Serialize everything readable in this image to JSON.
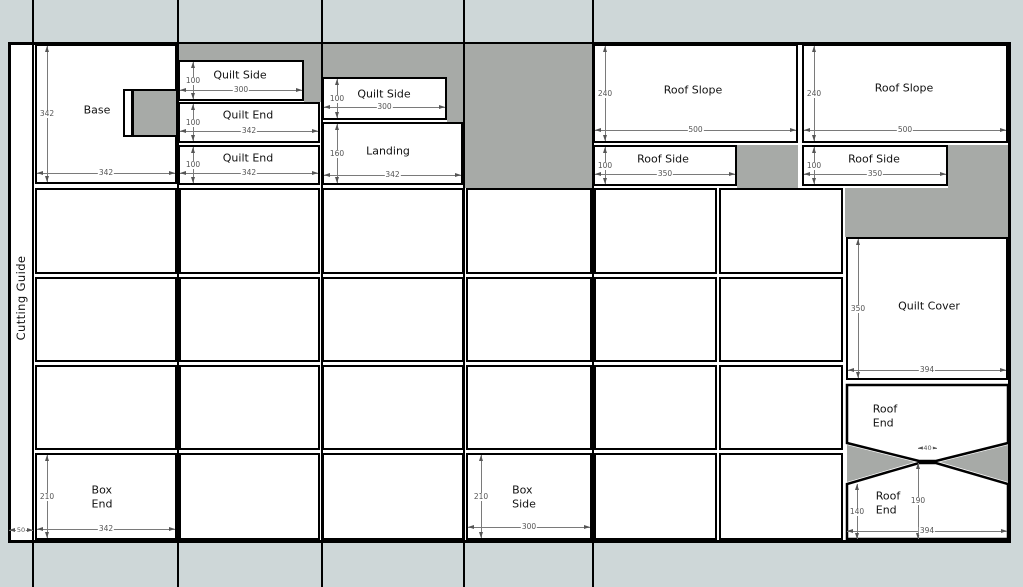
{
  "title": "Cutting Guide",
  "colors": {
    "background": "#ced7d8",
    "sheet": "#ffffff",
    "waste": "#a7aaa7",
    "outline": "#000000",
    "dim_line": "#7a7a7a",
    "dim_text": "#555555"
  },
  "sheet": {
    "x": 8,
    "y": 42,
    "w": 1003,
    "h": 501
  },
  "cut_lines_x": [
    33,
    178,
    322,
    464,
    593
  ],
  "waste_rects": [
    [
      178,
      44,
      144,
      16
    ],
    [
      304,
      60,
      18,
      42
    ],
    [
      322,
      44,
      142,
      33
    ],
    [
      447,
      77,
      17,
      45
    ],
    [
      464,
      44,
      129,
      144
    ],
    [
      737,
      145,
      61,
      43
    ],
    [
      948,
      145,
      60,
      43
    ],
    [
      845,
      188,
      163,
      49
    ]
  ],
  "notch_grey": [
    132,
    89,
    46,
    48
  ],
  "notch_white": [
    123,
    89,
    10,
    48
  ],
  "pieces": [
    {
      "name": "base",
      "label": "Base",
      "x": 35,
      "y": 44,
      "w": 142,
      "h": 140,
      "lc": [
        62,
        66
      ],
      "vdim": {
        "v": "342",
        "x": 10
      },
      "hdim": {
        "v": "342",
        "y": 127
      }
    },
    {
      "name": "quilt-side-1",
      "label": "Quilt Side",
      "x": 178,
      "y": 60,
      "w": 126,
      "h": 41,
      "lc": [
        62,
        15
      ],
      "vdim": {
        "v": "100",
        "x": 13
      },
      "hdim": {
        "v": "300",
        "y": 28
      }
    },
    {
      "name": "quilt-end-1",
      "label": "Quilt End",
      "x": 178,
      "y": 102,
      "w": 142,
      "h": 41,
      "lc": [
        70,
        13
      ],
      "vdim": {
        "v": "100",
        "x": 13
      },
      "hdim": {
        "v": "342",
        "y": 27
      }
    },
    {
      "name": "quilt-end-2",
      "label": "Quilt End",
      "x": 178,
      "y": 145,
      "w": 142,
      "h": 40,
      "lc": [
        70,
        13
      ],
      "vdim": {
        "v": "100",
        "x": 13
      },
      "hdim": {
        "v": "342",
        "y": 26
      }
    },
    {
      "name": "quilt-side-2",
      "label": "Quilt Side",
      "x": 322,
      "y": 77,
      "w": 125,
      "h": 43,
      "lc": [
        62,
        17
      ],
      "vdim": {
        "v": "100",
        "x": 13
      },
      "hdim": {
        "v": "300",
        "y": 28
      }
    },
    {
      "name": "landing",
      "label": "Landing",
      "x": 322,
      "y": 122,
      "w": 141,
      "h": 63,
      "lc": [
        66,
        29
      ],
      "vdim": {
        "v": "160",
        "x": 13
      },
      "hdim": {
        "v": "342",
        "y": 51
      }
    },
    {
      "name": "roof-slope-1",
      "label": "Roof Slope",
      "x": 593,
      "y": 44,
      "w": 205,
      "h": 99,
      "lc": [
        100,
        46
      ],
      "vdim": {
        "v": "240",
        "x": 10
      },
      "hdim": {
        "v": "500",
        "y": 84
      }
    },
    {
      "name": "roof-side-1",
      "label": "Roof Side",
      "x": 593,
      "y": 145,
      "w": 144,
      "h": 41,
      "lc": [
        70,
        14
      ],
      "vdim": {
        "v": "100",
        "x": 10
      },
      "hdim": {
        "v": "350",
        "y": 27
      }
    },
    {
      "name": "roof-slope-2",
      "label": "Roof Slope",
      "x": 802,
      "y": 44,
      "w": 206,
      "h": 99,
      "lc": [
        102,
        44
      ],
      "vdim": {
        "v": "240",
        "x": 10
      },
      "hdim": {
        "v": "500",
        "y": 84
      }
    },
    {
      "name": "roof-side-2",
      "label": "Roof Side",
      "x": 802,
      "y": 145,
      "w": 146,
      "h": 41,
      "lc": [
        72,
        14
      ],
      "vdim": {
        "v": "100",
        "x": 10
      },
      "hdim": {
        "v": "350",
        "y": 27
      }
    },
    {
      "name": "quilt-cover",
      "label": "Quilt Cover",
      "x": 846,
      "y": 237,
      "w": 162,
      "h": 143,
      "lc": [
        83,
        69
      ],
      "vdim": {
        "v": "350",
        "x": 10
      },
      "hdim": {
        "v": "394",
        "y": 131
      }
    },
    {
      "name": "box-end",
      "label": "Box\nEnd",
      "x": 35,
      "y": 453,
      "w": 142,
      "h": 87,
      "lc": [
        67,
        44
      ],
      "vdim": {
        "v": "210",
        "x": 10
      },
      "hdim": {
        "v": "342",
        "y": 74
      }
    },
    {
      "name": "box-side",
      "label": "Box\nSide",
      "x": 466,
      "y": 453,
      "w": 126,
      "h": 87,
      "lc": [
        58,
        44
      ],
      "vdim": {
        "v": "210",
        "x": 13
      },
      "hdim": {
        "v": "300",
        "y": 72
      }
    }
  ],
  "blank_panels": [
    [
      35,
      188,
      142,
      86
    ],
    [
      179,
      188,
      141,
      86
    ],
    [
      322,
      188,
      142,
      86
    ],
    [
      466,
      188,
      126,
      86
    ],
    [
      594,
      188,
      123,
      86
    ],
    [
      719,
      188,
      124,
      86
    ],
    [
      35,
      277,
      142,
      85
    ],
    [
      179,
      277,
      141,
      85
    ],
    [
      322,
      277,
      142,
      85
    ],
    [
      466,
      277,
      126,
      85
    ],
    [
      594,
      277,
      123,
      85
    ],
    [
      719,
      277,
      124,
      85
    ],
    [
      35,
      365,
      142,
      85
    ],
    [
      179,
      365,
      141,
      85
    ],
    [
      322,
      365,
      142,
      85
    ],
    [
      466,
      365,
      126,
      85
    ],
    [
      594,
      365,
      123,
      85
    ],
    [
      719,
      365,
      124,
      85
    ],
    [
      179,
      453,
      141,
      87
    ],
    [
      322,
      453,
      142,
      87
    ],
    [
      594,
      453,
      123,
      87
    ],
    [
      719,
      453,
      124,
      87
    ]
  ],
  "polygons": [
    {
      "name": "roof-end-top",
      "label": "Roof\nEnd",
      "fill": "white",
      "points": "847,385 1008,385 1008,443 936,461 919,461 847,443",
      "lc": [
        885,
        416
      ]
    },
    {
      "name": "roof-end-bottom",
      "label": "Roof\nEnd",
      "fill": "white",
      "points": "919,463 936,463 1008,484 1008,539 847,539 847,484",
      "lc": [
        888,
        503
      ]
    },
    {
      "name": "waste-triangle-left",
      "label": null,
      "fill": "waste",
      "points": "847,445 915,462 847,482",
      "lc": null
    },
    {
      "name": "waste-triangle-right",
      "label": null,
      "fill": "waste",
      "points": "1008,445 940,462 1008,482",
      "lc": null
    }
  ],
  "stage_dims": [
    {
      "t": "h",
      "v": "50",
      "x1": 9,
      "x2": 33,
      "y": 530,
      "small": true
    },
    {
      "t": "h",
      "v": "40",
      "x1": 918,
      "x2": 937,
      "y": 448,
      "small": true
    },
    {
      "t": "v",
      "v": "140",
      "x": 857,
      "y1": 484,
      "y2": 539
    },
    {
      "t": "v",
      "v": "190",
      "x": 918,
      "y1": 463,
      "y2": 539
    },
    {
      "t": "h",
      "v": "394",
      "x1": 847,
      "x2": 1007,
      "y": 531
    }
  ]
}
